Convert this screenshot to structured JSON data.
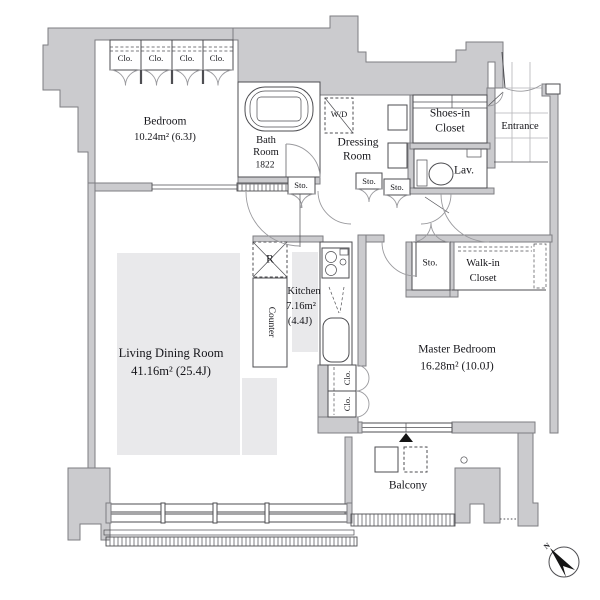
{
  "labels": {
    "bedroom_name": "Bedroom",
    "bedroom_area": "10.24m²  (6.3J)",
    "closet_abbr": "Clo.",
    "storage_abbr": "Sto.",
    "bath_line1": "Bath",
    "bath_line2": "Room",
    "bath_size": "1822",
    "washer_dryer": "W/D",
    "dressing_line1": "Dressing",
    "dressing_line2": "Room",
    "shoes_line1": "Shoes-in",
    "shoes_line2": "Closet",
    "entrance": "Entrance",
    "lavatory": "Lav.",
    "walkin_line1": "Walk-in",
    "walkin_line2": "Closet",
    "master_name": "Master Bedroom",
    "master_area": "16.28m²  (10.0J)",
    "kitchen_name": "Kitchen",
    "kitchen_area": "7.16m²",
    "kitchen_tatami": "(4.4J)",
    "counter": "Counter",
    "fridge": "R",
    "living_name": "Living Dining Room",
    "living_area": "41.16m²  (25.4J)",
    "balcony": "Balcony",
    "compass_north": "N"
  },
  "colors": {
    "wall_fill": "#cbcbce",
    "wall_stroke": "#7e7e82",
    "line": "#4e4e52",
    "door_arc": "#9a9a9e",
    "floor_shade": "#e9e9eb",
    "tile_line": "#b4b4b8",
    "black": "#141414"
  }
}
